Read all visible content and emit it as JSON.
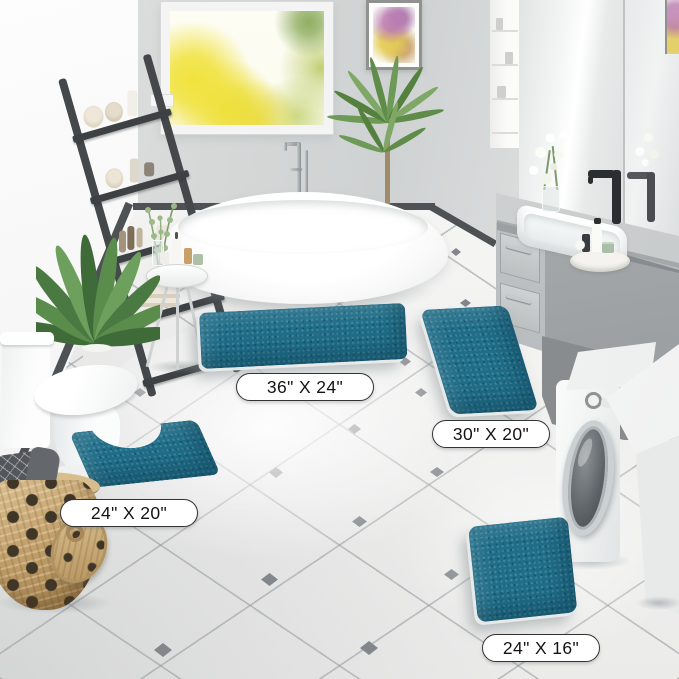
{
  "rug_size_labels": {
    "large": "36\" X 24\"",
    "runner": "30\" X 20\"",
    "contour": "24\" X 20\"",
    "small": "24\" X 16\""
  },
  "colors": {
    "rug_teal": "#1f6e89",
    "tile_accent": "#83878b",
    "baseboard": "#4e5254",
    "ladder_gray": "#45484b",
    "basket_tan": "#c3a26e",
    "label_border": "#333333"
  }
}
